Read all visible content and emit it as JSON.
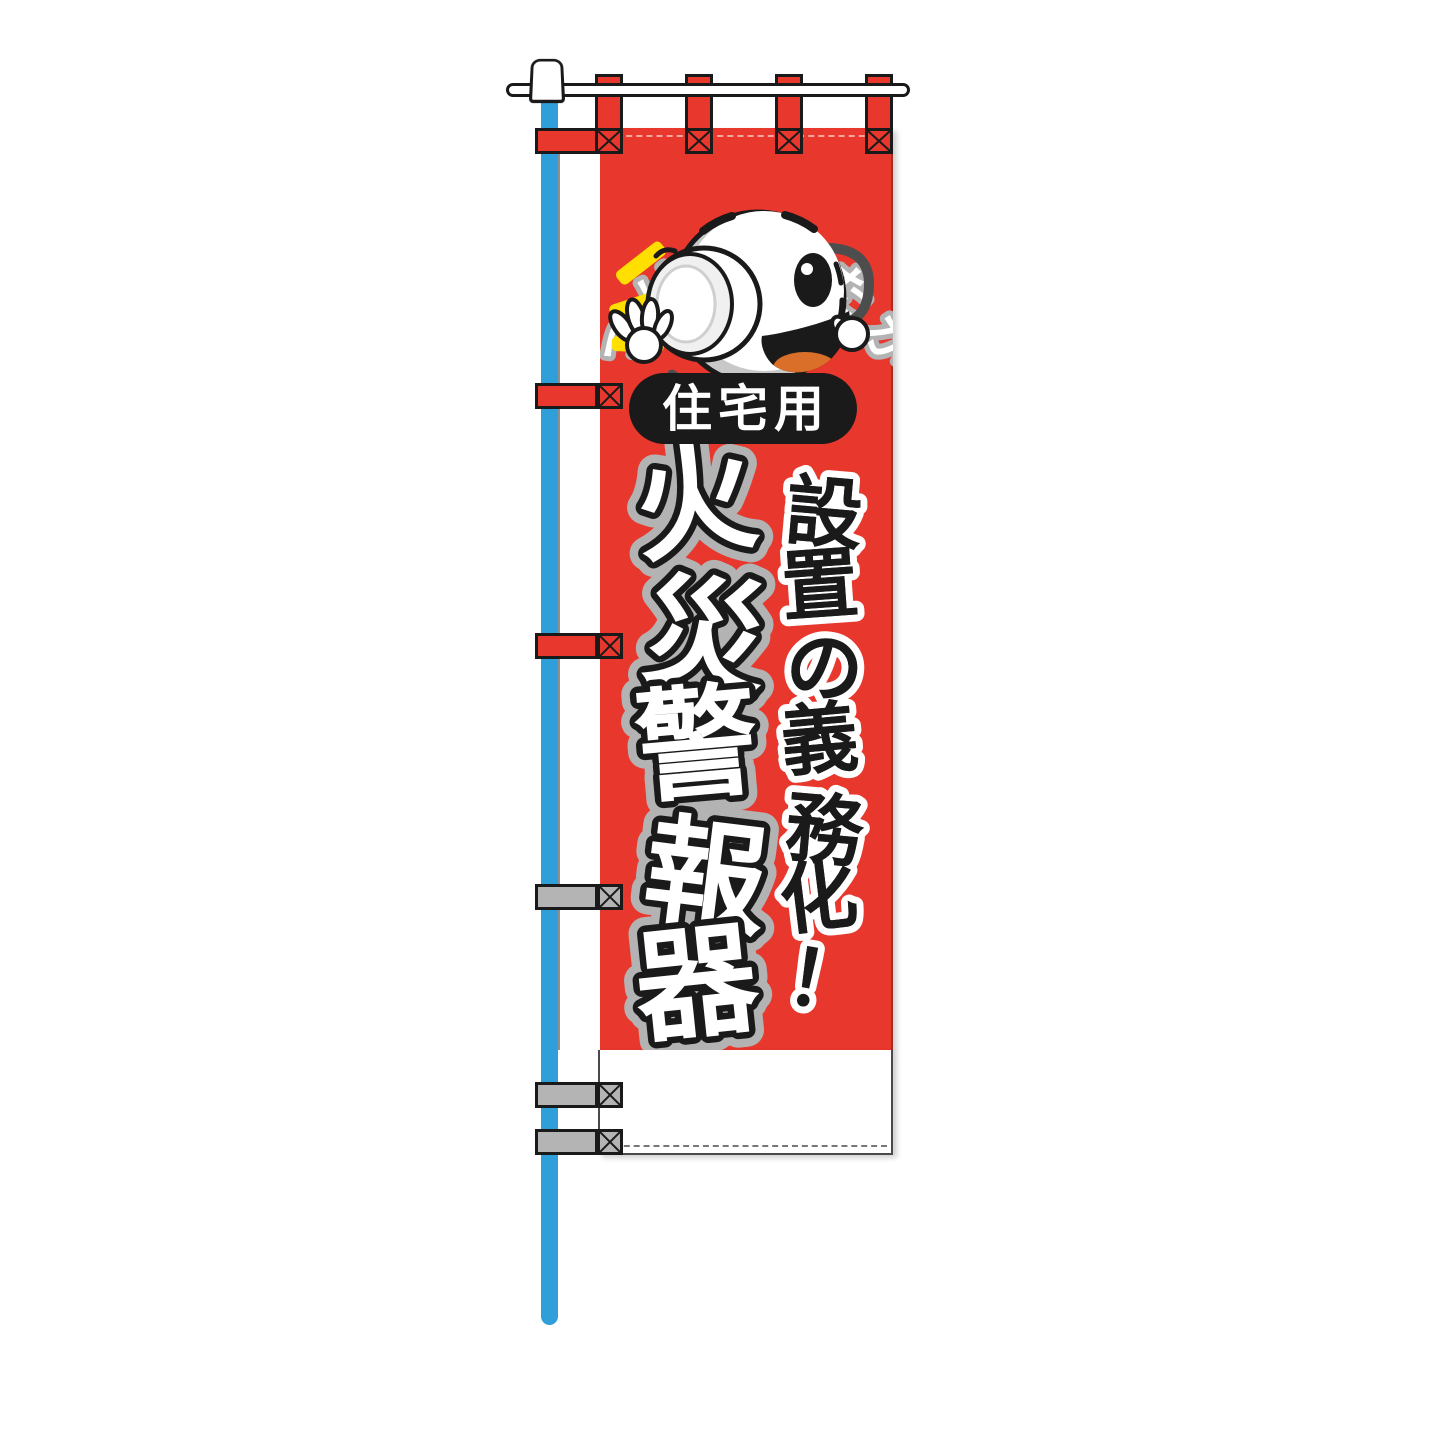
{
  "banner": {
    "arch_question": "つけましたか？",
    "usage_badge": "住宅用",
    "main_title": "火災警報器",
    "sub_title": "設置の義務化！"
  },
  "mascot": {
    "icon": "smoke-detector-mascot-icon"
  },
  "palette": {
    "banner_red": "#e8372c",
    "pole_blue": "#2e9fd8",
    "strap_gray": "#b4b4b4",
    "outline_black": "#1a1a1a",
    "ray_yellow": "#ffdf00",
    "title_outline_gray": "#b3b3b3",
    "tongue_orange": "#d96f28"
  }
}
